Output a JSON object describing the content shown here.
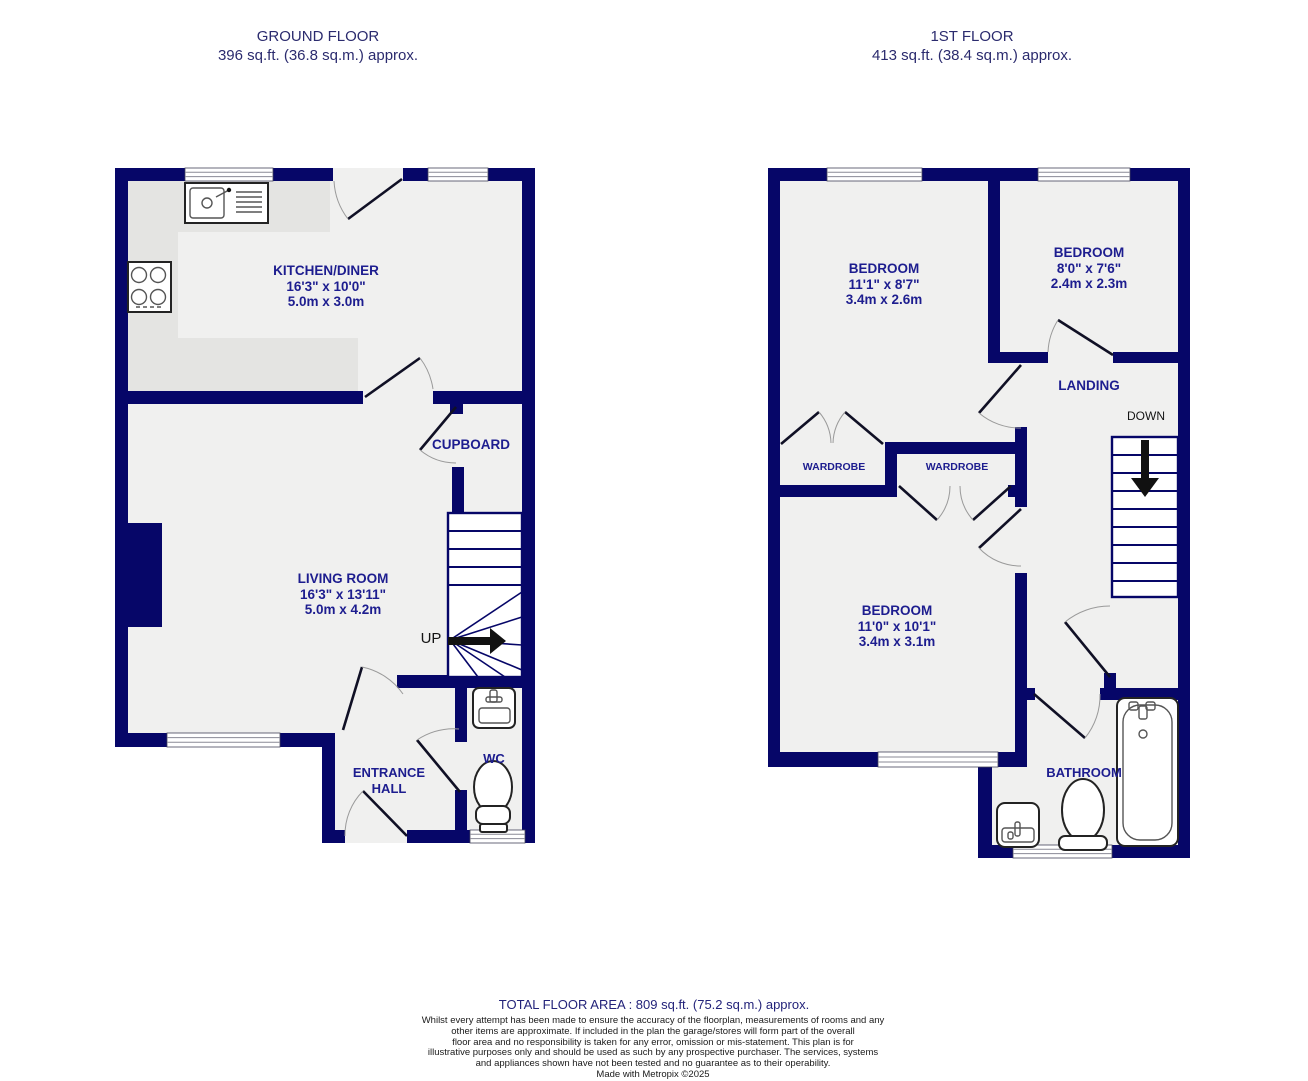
{
  "colors": {
    "wall": "#060668",
    "label_text": "#1d1d8f",
    "title_text": "#2b2b6e",
    "floor": "#f0f0ef",
    "counter": "#e4e4e2",
    "arrow": "#111111",
    "background": "#ffffff"
  },
  "ground_floor": {
    "title": "GROUND FLOOR",
    "subtitle": "396 sq.ft. (36.8 sq.m.) approx.",
    "rooms": {
      "kitchen": {
        "name": "KITCHEN/DINER",
        "dims_ft": "16'3\" x 10'0\"",
        "dims_m": "5.0m x 3.0m"
      },
      "living": {
        "name": "LIVING ROOM",
        "dims_ft": "16'3\" x 13'11\"",
        "dims_m": "5.0m x 4.2m"
      },
      "cupboard": {
        "name": "CUPBOARD"
      },
      "entrance_line1": "ENTRANCE",
      "entrance_line2": "HALL",
      "wc": {
        "name": "WC"
      }
    },
    "stairs_label": "UP",
    "icons": [
      "sink-icon",
      "hob-icon",
      "basin-icon",
      "toilet-icon",
      "staircase-up"
    ]
  },
  "first_floor": {
    "title": "1ST FLOOR",
    "subtitle": "413 sq.ft. (38.4 sq.m.) approx.",
    "rooms": {
      "bedroom1": {
        "name": "BEDROOM",
        "dims_ft": "11'1\" x 8'7\"",
        "dims_m": "3.4m x 2.6m"
      },
      "bedroom2": {
        "name": "BEDROOM",
        "dims_ft": "8'0\" x 7'6\"",
        "dims_m": "2.4m x 2.3m"
      },
      "bedroom3": {
        "name": "BEDROOM",
        "dims_ft": "11'0\" x 10'1\"",
        "dims_m": "3.4m x 3.1m"
      },
      "landing": {
        "name": "LANDING"
      },
      "wardrobe1": {
        "name": "WARDROBE"
      },
      "wardrobe2": {
        "name": "WARDROBE"
      },
      "bathroom": {
        "name": "BATHROOM"
      }
    },
    "stairs_label": "DOWN",
    "icons": [
      "bathtub-icon",
      "toilet-icon",
      "basin-icon",
      "staircase-down"
    ]
  },
  "footer": {
    "total": "TOTAL FLOOR AREA : 809 sq.ft. (75.2 sq.m.) approx.",
    "disclaimer_lines": [
      "Whilst every attempt has been made to ensure the accuracy of the floorplan, measurements of rooms and any",
      "other items are approximate. If included in the plan the garage/stores will form part of the overall",
      "floor area and no responsibility is taken for any error, omission or mis-statement. This plan is for",
      "illustrative purposes only and should be used as such by any prospective purchaser. The services, systems",
      "and appliances shown have not been tested and no guarantee as to their operability."
    ],
    "credit": "Made with Metropix ©2025"
  }
}
